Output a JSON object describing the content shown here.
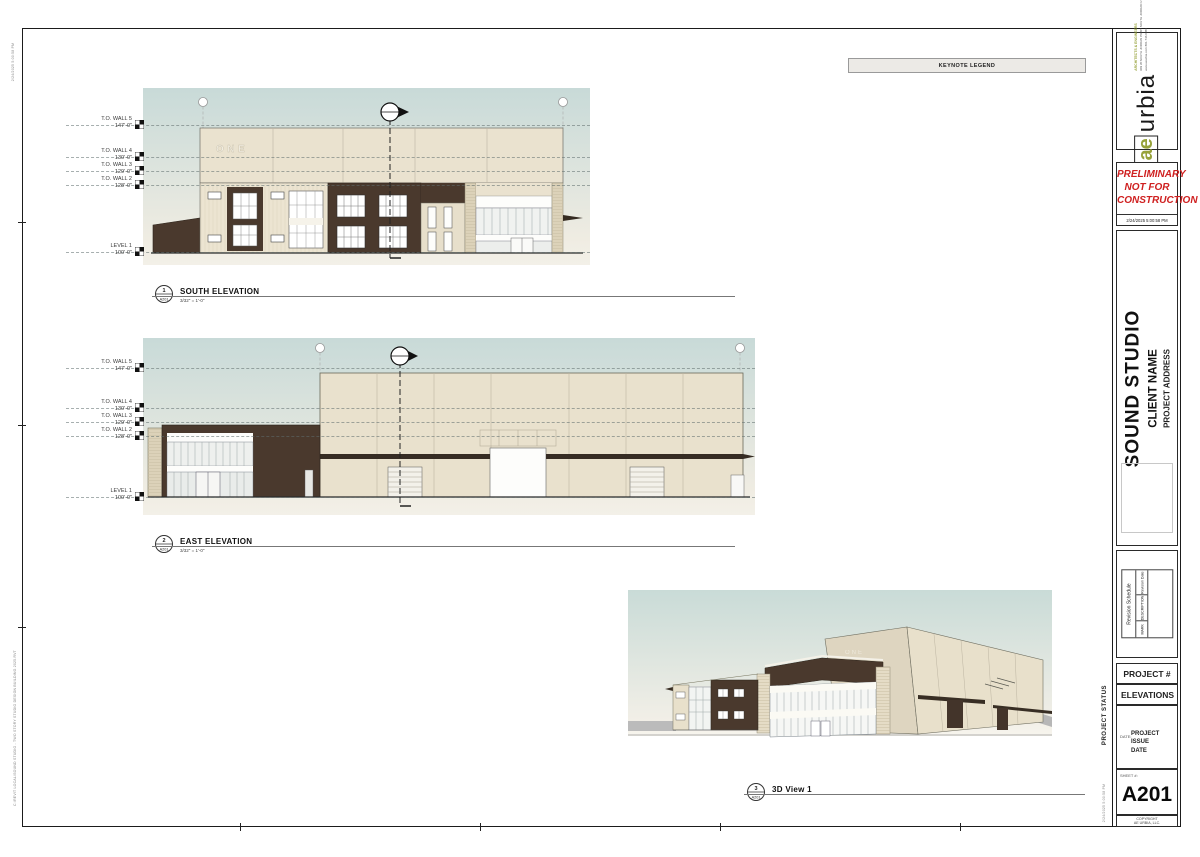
{
  "sheet": {
    "keynote_legend_title": "KEYNOTE LEGEND",
    "stamp_datetime": "2/24/2025 5:00:58 PM",
    "stamp_path": "C:\\REVIT LOCAL\\SOUND STUDIO - TWO STORY STUDIO DESIGN BUILDING 2025.RVT"
  },
  "building": {
    "sign": "ONE"
  },
  "levels": [
    {
      "name": "T.O. WALL 5",
      "elev": "147'-0\""
    },
    {
      "name": "T.O. WALL 4",
      "elev": "130'-0\""
    },
    {
      "name": "T.O. WALL 3",
      "elev": "129'-0\""
    },
    {
      "name": "T.O. WALL 2",
      "elev": "128'-0\""
    },
    {
      "name": "LEVEL 1",
      "elev": "100'-0\""
    }
  ],
  "views": {
    "south": {
      "num": "1",
      "ref": "A201",
      "title": "SOUTH ELEVATION",
      "scale": "3/32\" = 1'-0\""
    },
    "east": {
      "num": "2",
      "ref": "A201",
      "title": "EAST ELEVATION",
      "scale": "3/32\" = 1'-0\""
    },
    "view3d": {
      "num": "3",
      "ref": "A201",
      "title": "3D View 1",
      "scale": ""
    }
  },
  "titleblock": {
    "logo_ae": "ae",
    "logo_urbia": "urbia",
    "logo_tagline": "ARCHITECTS & ENGINEERS",
    "logo_address": "909 W SOUTH JORDAN PKWY SOUTH JORDAN UT 84095",
    "logo_contact": "www.aeurbia.com   801.746.0456",
    "preliminary_line1": "PRELIMINARY",
    "preliminary_line2": "NOT FOR",
    "preliminary_line3": "CONSTRUCTION",
    "preliminary_datetime": "2/24/2025 5:00:58 PM",
    "project_name": "SOUND STUDIO",
    "client_name": "CLIENT NAME",
    "project_address": "PROJECT ADDRESS",
    "revision_title": "Revision Schedule",
    "revision_col_mark": "MARK",
    "revision_col_desc": "DESCRIPTION",
    "revision_col_date": "Revision Date",
    "project_number": "PROJECT #",
    "sheet_title": "ELEVATIONS",
    "date_label": "DATE:",
    "issue_date_line1": "PROJECT ISSUE",
    "issue_date_line2": "DATE",
    "sheet_label": "SHEET #:",
    "sheet_number": "A201",
    "copyright_line1": "COPYRIGHT",
    "copyright_line2": "AE URBIA, LLC.",
    "project_status": "PROJECT STATUS"
  },
  "colors": {
    "sky_top": "#c8dad8",
    "sky_bottom": "#f2efe7",
    "wall_tan": "#e9e1cd",
    "accent_brown": "#4a392d",
    "preliminary_red": "#cf2020",
    "logo_green": "#97a23a"
  }
}
